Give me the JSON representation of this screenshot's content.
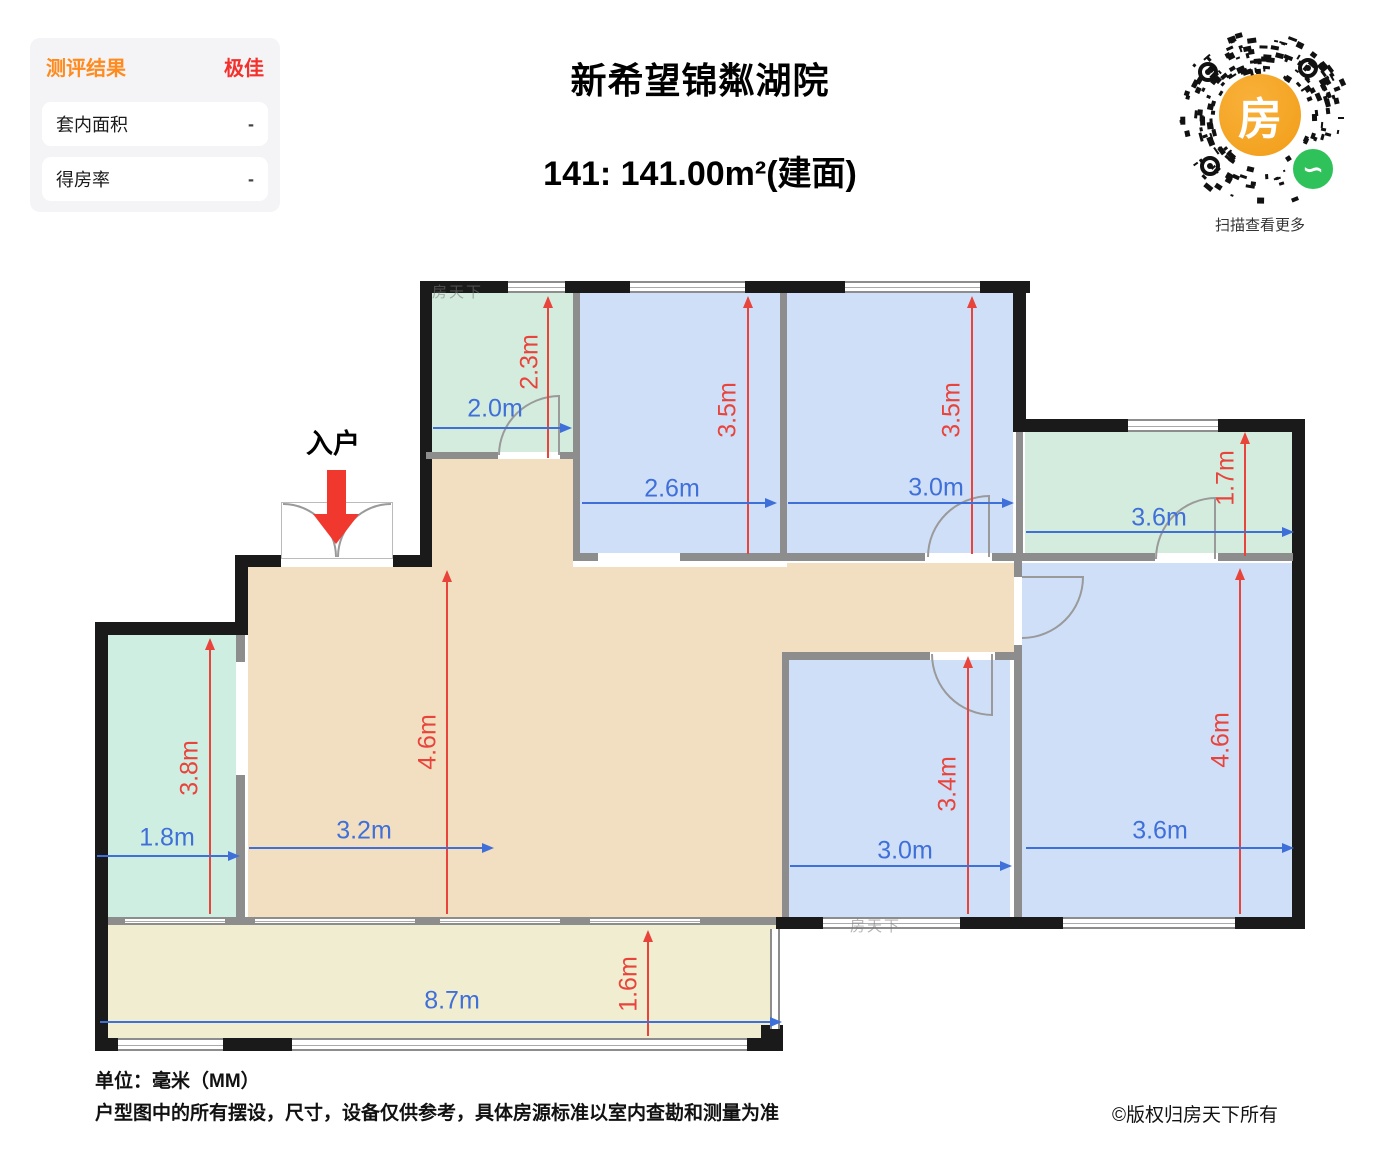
{
  "eval_panel": {
    "title": "测评结果",
    "title_color": "#ff8a1e",
    "rating": "极佳",
    "rating_color": "#f3302b",
    "rows": [
      {
        "label": "套内面积",
        "value": "-"
      },
      {
        "label": "得房率",
        "value": "-"
      }
    ]
  },
  "header": {
    "title": "新希望锦粼湖院",
    "subtitle": "141: 141.00m²(建面)"
  },
  "qr": {
    "center_glyph": "房",
    "mini_glyph": "∽",
    "caption": "扫描查看更多",
    "orange": "#f19e17",
    "green": "#2fc25b"
  },
  "plan": {
    "entrance_label": "入户",
    "watermark": "房天下",
    "colors": {
      "bedroom_blue": "#cfdff7",
      "utility_green": "#d4ecde",
      "living_beige": "#f2dfc1",
      "balcony_yellow": "#f0edd0",
      "wall_exterior": "#1a1a1a",
      "wall_interior": "#8d8d8d",
      "dim_red": "#e8443c",
      "dim_blue": "#3f6fd8"
    },
    "dims": {
      "tl_green_w": "2.0m",
      "tl_green_h": "2.3m",
      "r1_w": "2.6m",
      "r1_h": "3.5m",
      "r2_w": "3.0m",
      "r2_h": "3.5m",
      "tr_green_w": "3.6m",
      "tr_green_h": "1.7m",
      "left_green_w": "1.8m",
      "left_green_h": "3.8m",
      "living_w": "3.2m",
      "living_h": "4.6m",
      "bm_w": "3.0m",
      "bm_h": "3.4m",
      "right_w": "3.6m",
      "right_h": "4.6m",
      "balcony_w": "8.7m",
      "balcony_h": "1.6m"
    }
  },
  "footer": {
    "unit": "单位：毫米（MM）",
    "disclaimer": "户型图中的所有摆设，尺寸，设备仅供参考，具体房源标准以室内查勘和测量为准",
    "copyright": "©版权归房天下所有"
  }
}
